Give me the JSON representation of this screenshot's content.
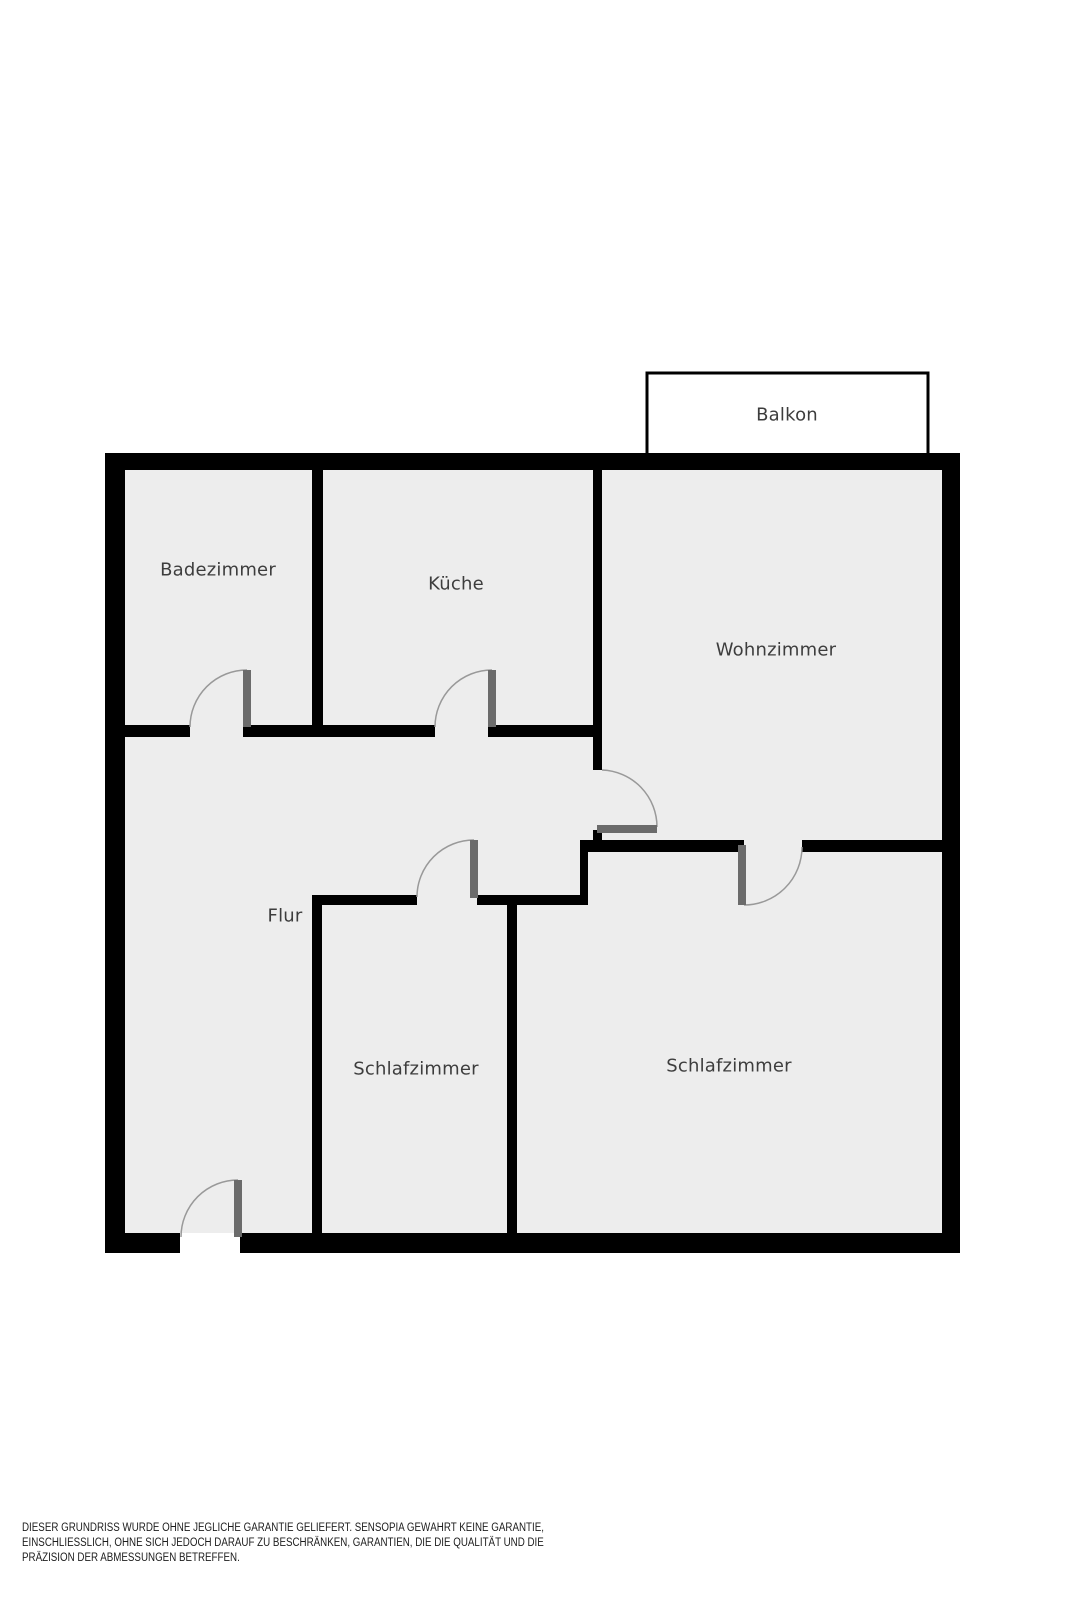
{
  "rooms": {
    "balkon": {
      "label": "Balkon"
    },
    "badezimmer": {
      "label": "Badezimmer"
    },
    "kueche": {
      "label": "Küche"
    },
    "wohnzimmer": {
      "label": "Wohnzimmer"
    },
    "flur": {
      "label": "Flur"
    },
    "schlafzimmer_links": {
      "label": "Schlafzimmer"
    },
    "schlafzimmer_rechts": {
      "label": "Schlafzimmer"
    }
  },
  "disclaimer": {
    "lines": [
      "DIESER GRUNDRISS WURDE OHNE JEGLICHE GARANTIE GELIEFERT. SENSOPIA GEWÄHRT KEINE GARANTIE,",
      "EINSCHLIESSLICH, OHNE SICH JEDOCH DARAUF ZU BESCHRÄNKEN, GARANTIEN, DIE DIE QUALITÄT UND DIE",
      "PRÄZISION DER ABMESSUNGEN BETREFFEN."
    ]
  },
  "colors": {
    "wall": "#000000",
    "floor": "#ededed",
    "balcony_fill": "#ffffff",
    "door_panel": "#6b6b6b",
    "door_swing_arc": "#999999",
    "label_text": "#3d3d3d",
    "disclaimer_text": "#1c1c1c"
  }
}
